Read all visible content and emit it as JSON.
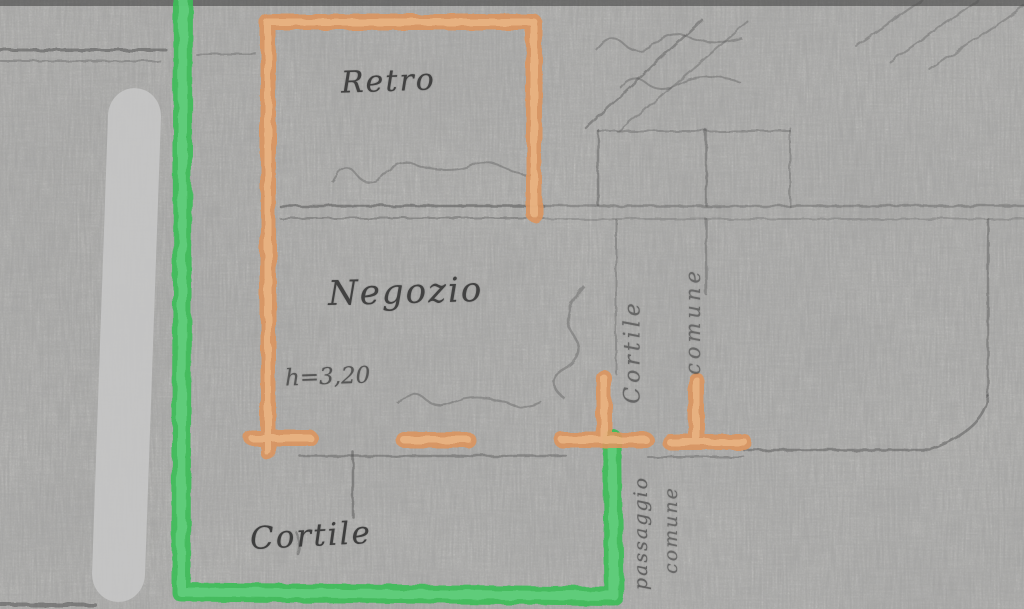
{
  "plan": {
    "room_labels": {
      "retro": "Retro",
      "negozio": "Negozio",
      "cortile": "Cortile"
    },
    "annotations": {
      "ceiling_height": "h=3,20",
      "side_top_word1": "Cortile",
      "side_top_word2": "comune",
      "side_bottom_word1": "passaggio",
      "side_bottom_word2": "comune"
    },
    "legend_colors": {
      "highlight_orange": "#dc955e",
      "highlight_green": "#3dbd58",
      "road_band_gray": "#c5c5c5",
      "pencil_gray": "#4a4a4a",
      "paper": "#d9d8d5"
    }
  }
}
